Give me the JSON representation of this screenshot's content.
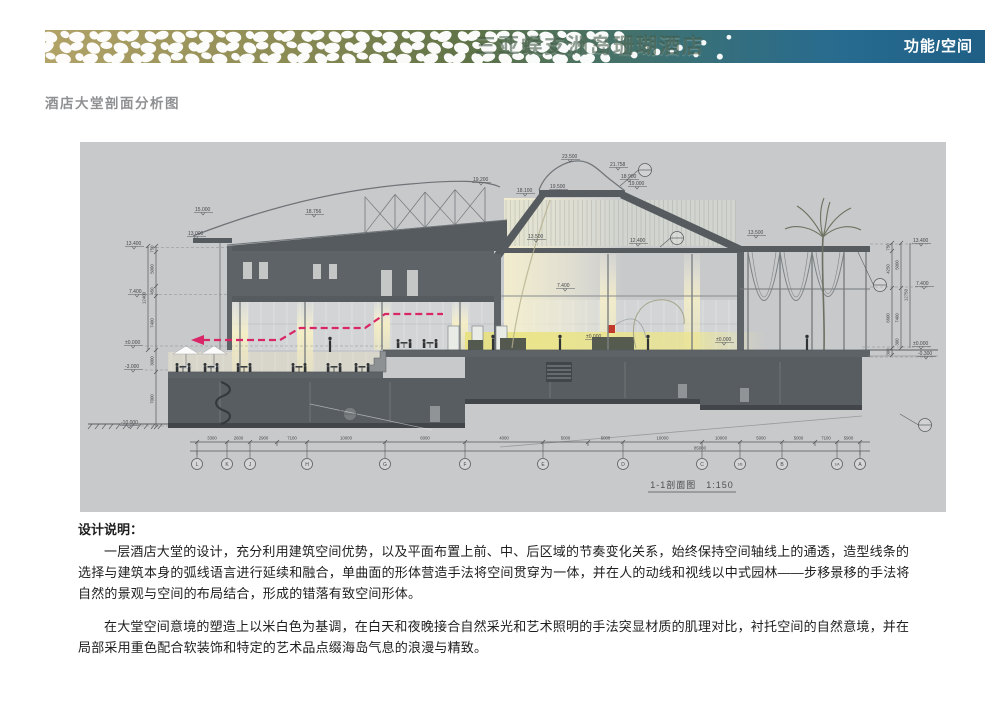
{
  "header": {
    "brand_title": "三亚蜈支洲岛珊瑚酒店",
    "page_tag": "功能/空间"
  },
  "section_heading": "酒店大堂剖面分析图",
  "colors": {
    "canvas": "#c8c9cb",
    "accent_magenta": "#d92667",
    "header_left_gold": "#b3a469",
    "header_right_blue": "#1f5f86",
    "dark_structure": "#565b5f"
  },
  "drawing": {
    "title": "1-1剖面图　1:150",
    "elevations": {
      "left_13400": "13.400",
      "left_7400": "7.400",
      "left_0": "±0.000",
      "left_n3000": "-3.000",
      "left_n10000": "-10.000",
      "canopy_15000": "15.000",
      "canopy_13000": "13.000",
      "truss_19200": "19.200",
      "truss_18756": "18.756",
      "tower_23500": "23.500",
      "tower_21758": "21.758",
      "tower_19500": "19.500",
      "tower_18900": "18.900",
      "tower_19000": "19.000",
      "tower_18100": "18.100",
      "hall_13500": "13.500",
      "hall_12400": "12.400",
      "wing_13500": "13.500",
      "hall_7400": "7.400",
      "hall_0": "±0.000",
      "hall_0b": "±0.000",
      "right_13400": "13.400",
      "right_7400": "7.400",
      "right_0": "±0.000",
      "right_n0300": "-0.300"
    },
    "left_chain": {
      "dims": [
        "750",
        "5000",
        "450",
        "7400",
        "3000",
        "7000"
      ],
      "total": "12400"
    },
    "right_chain": {
      "dims": [
        "750",
        "4250",
        "6600",
        "300"
      ],
      "dims2": [
        "5000",
        "7400",
        "300"
      ],
      "total": "12750"
    },
    "grid": {
      "letters": [
        "L",
        "K",
        "J",
        "H",
        "G",
        "F",
        "E",
        "D",
        "C",
        "1/B",
        "B",
        "1/A",
        "A"
      ]
    },
    "bottom_dims": [
      "3300",
      "2600",
      "2900",
      "7100",
      "10000",
      "6000",
      "4000",
      "5000",
      "5000",
      "10000",
      "10000",
      "5000",
      "5000",
      "7100",
      "5900"
    ],
    "total_dim": "85000"
  },
  "notes": {
    "heading": "设计说明：",
    "p1": "一层酒店大堂的设计，充分利用建筑空间优势，以及平面布置上前、中、后区域的节奏变化关系，始终保持空间轴线上的通透，造型线条的选择与建筑本身的弧线语言进行延续和融合，单曲面的形体营造手法将空间贯穿为一体，并在人的动线和视线以中式园林——步移景移的手法将自然的景观与空间的布局结合，形成的错落有致空间形体。",
    "p2": "在大堂空间意境的塑造上以米白色为基调，在白天和夜晚接合自然采光和艺术照明的手法突显材质的肌理对比，衬托空间的自然意境，并在局部采用重色配合软装饰和特定的艺术品点缀海岛气息的浪漫与精致。"
  }
}
